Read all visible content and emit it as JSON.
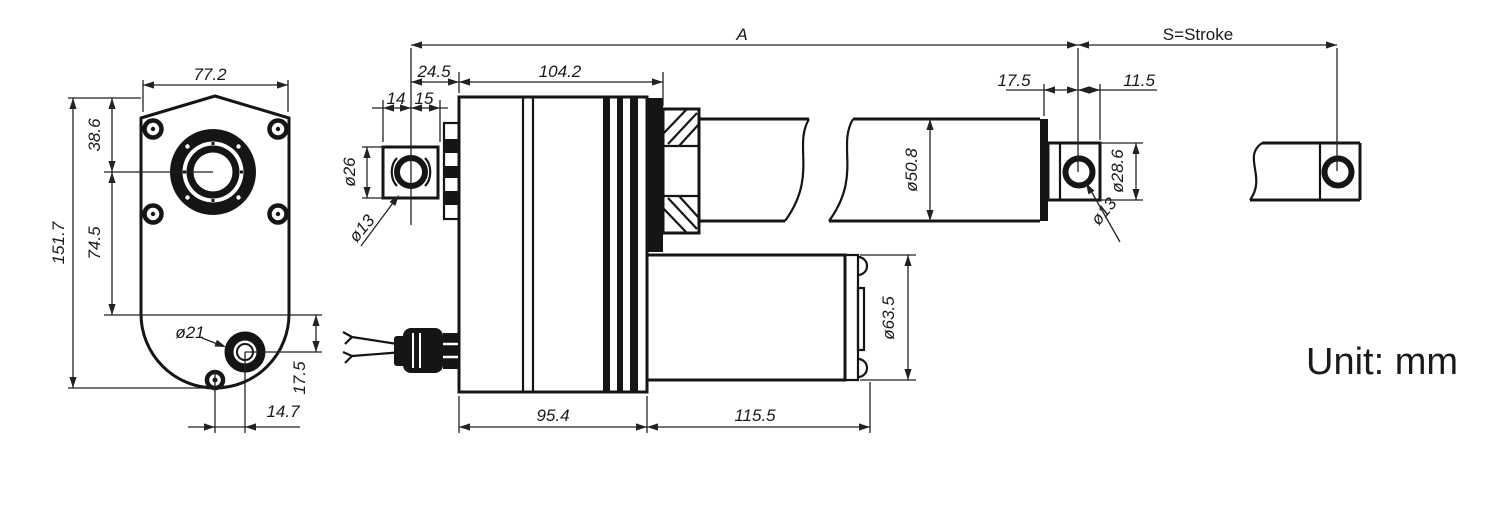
{
  "drawing": {
    "title": "Linear actuator dimension drawing",
    "unit_label": "Unit: mm",
    "front_view": {
      "width_top": "77.2",
      "total_height": "151.7",
      "top_to_center": "38.6",
      "center_to_step": "74.5",
      "boss_dia": "ø21",
      "boss_vertical": "17.5",
      "boss_horizontal": "14.7"
    },
    "side_view": {
      "overall_len": "A",
      "stroke_len": "S=Stroke",
      "clevis_to_face": "24.5",
      "housing_len": "104.2",
      "clevis_pin_left": "14",
      "clevis_pin_right": "15",
      "clevis_od": "ø26",
      "clevis_hole": "ø13",
      "tube_dia": "ø50.8",
      "body_len": "95.4",
      "motor_len": "115.5",
      "motor_dia": "ø63.5",
      "rodend_offset": "17.5",
      "rodend_tab": "11.5",
      "rodeye_od": "ø28.6",
      "rodeye_hole": "ø13"
    }
  }
}
